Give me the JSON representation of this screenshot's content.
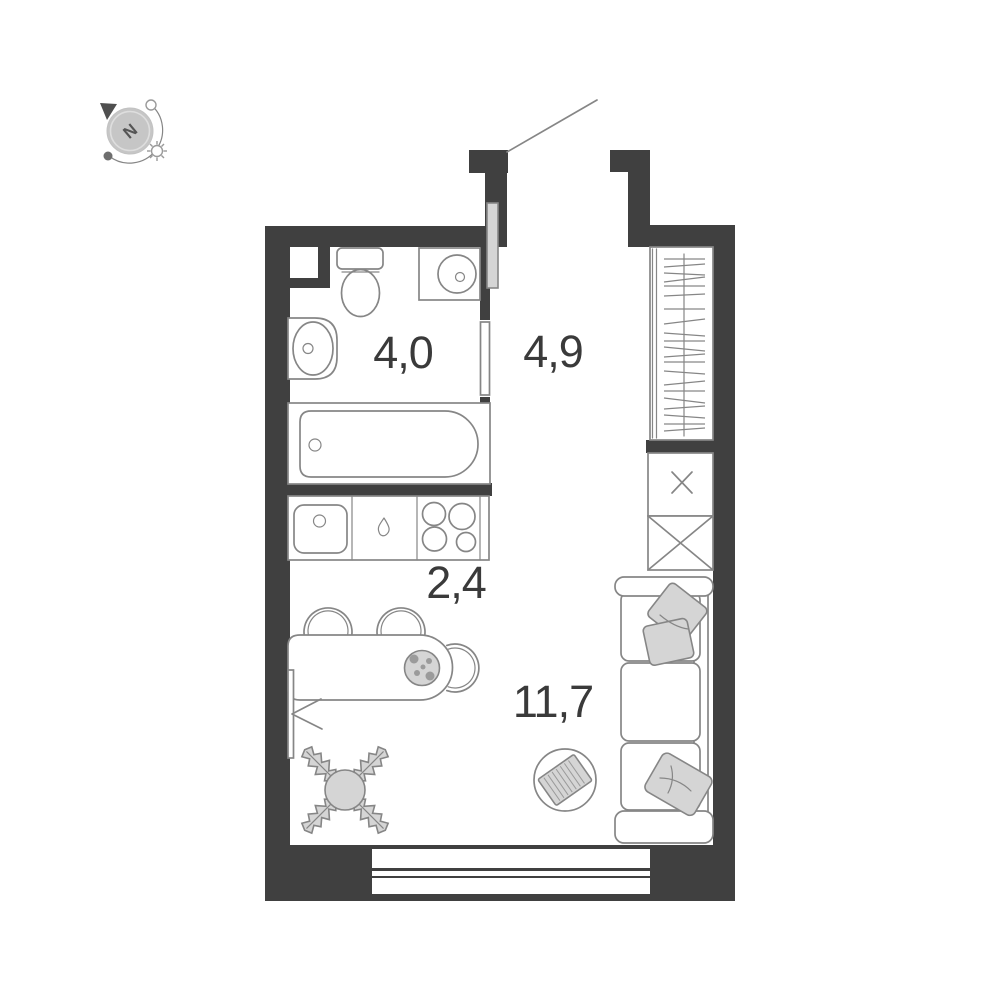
{
  "plan": {
    "title": "Studio apartment floor plan",
    "compass": {
      "north_label": "N"
    },
    "rooms": [
      {
        "name": "bathroom",
        "area_label": "4,0"
      },
      {
        "name": "hallway",
        "area_label": "4,9"
      },
      {
        "name": "kitchen",
        "area_label": "2,4"
      },
      {
        "name": "living-room",
        "area_label": "11,7"
      }
    ],
    "symbols": [
      "compass",
      "toilet",
      "washing-machine",
      "bathroom-sink",
      "bathtub",
      "bathroom-door",
      "entry-door",
      "kitchen-sink",
      "stove-burners",
      "dining-table",
      "chairs",
      "plate",
      "radiator",
      "plant",
      "pouf",
      "sofa",
      "pillows",
      "wardrobe",
      "cabinets",
      "window",
      "vent-shaft"
    ],
    "colors": {
      "wall": "#404040",
      "outline": "#868686",
      "light_fill": "#d5d5d5",
      "label_text": "#3a3a3a",
      "background": "#ffffff"
    }
  }
}
